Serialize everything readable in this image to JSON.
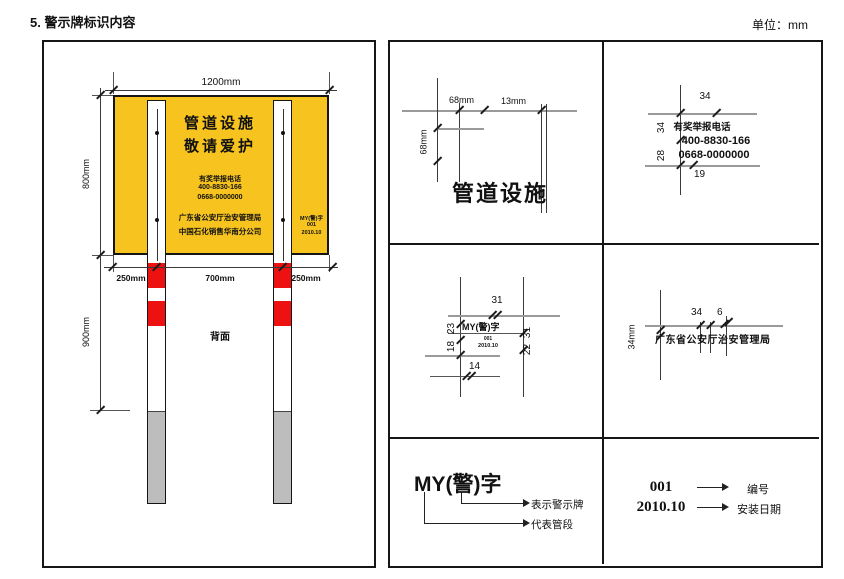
{
  "page": {
    "title": "5. 警示牌标识内容",
    "unit_label": "单位：mm"
  },
  "colors": {
    "sign_yellow": "#F7C41F",
    "band_red": "#EE1111",
    "buried_gray": "#BDBDBD"
  },
  "sign_board": {
    "title_line1": "管道设施",
    "title_line2": "敬请爱护",
    "hotline_label": "有奖举报电话",
    "hotline_number1": "400-8830-166",
    "hotline_number2": "0668-0000000",
    "agency_line1": "广东省公安厅治安管理局",
    "agency_line2": "中国石化销售华南分公司",
    "code_line1": "MY(警)字",
    "code_line2": "001",
    "code_line3": "2010.10"
  },
  "front_view": {
    "dim_width": "1200mm",
    "dim_height": "800mm",
    "dim_left_offset": "250mm",
    "dim_center_span": "700mm",
    "dim_right_offset": "250mm",
    "dim_post_height": "900mm",
    "back_label": "背面"
  },
  "detail_title": {
    "text": "管道设施",
    "dim_char_width": "68mm",
    "dim_gap": "13mm",
    "dim_char_height": "68mm"
  },
  "detail_phone": {
    "label": "有奖举报电话",
    "number1": "400-8830-166",
    "number2": "0668-0000000",
    "dim_top": "34",
    "dim_left_upper": "34",
    "dim_left_lower": "28",
    "dim_bottom": "19"
  },
  "detail_code": {
    "line1": "MY(警)字",
    "line2": "001",
    "line3": "2010.10",
    "dim_top": "31",
    "dim_left_upper": "23",
    "dim_left_lower": "18",
    "dim_right_upper": "31",
    "dim_right_lower": "22",
    "dim_bottom": "14"
  },
  "detail_agency": {
    "text": "广东省公安厅治安管理局",
    "dim_top_left": "34",
    "dim_top_right": "6",
    "dim_left": "34mm"
  },
  "legend_code": {
    "code": "MY(警)字",
    "meaning_top": "表示警示牌",
    "meaning_bottom": "代表管段"
  },
  "legend_number": {
    "value1": "001",
    "label1": "编号",
    "value2": "2010.10",
    "label2": "安装日期"
  }
}
